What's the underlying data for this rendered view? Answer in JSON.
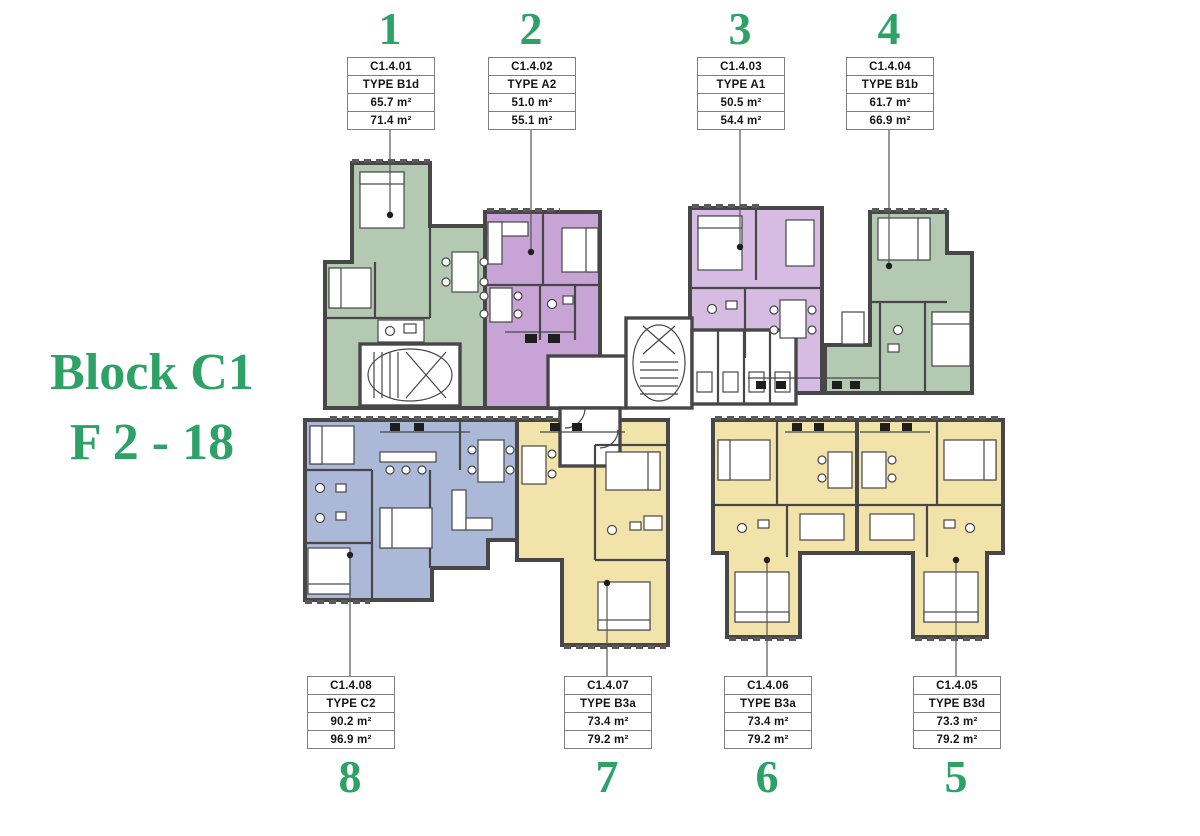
{
  "title": {
    "block": "Block C1",
    "floors": "F 2 - 18"
  },
  "colors": {
    "accent_green": "#2EA166",
    "wall": "#474747",
    "leader": "#555555",
    "box_border": "#7F7F7F",
    "unit_green": "#B3C9B1",
    "unit_purple": "#C7A3D6",
    "unit_lavender": "#D6BCE3",
    "unit_blue": "#ABB8D7",
    "unit_yellow": "#F2E3AA"
  },
  "units": [
    {
      "number": "1",
      "code": "C1.4.01",
      "type": "TYPE B1d",
      "area_net": "65.7 m²",
      "area_gross": "71.4 m²"
    },
    {
      "number": "2",
      "code": "C1.4.02",
      "type": "TYPE A2",
      "area_net": "51.0 m²",
      "area_gross": "55.1 m²"
    },
    {
      "number": "3",
      "code": "C1.4.03",
      "type": "TYPE A1",
      "area_net": "50.5 m²",
      "area_gross": "54.4 m²"
    },
    {
      "number": "4",
      "code": "C1.4.04",
      "type": "TYPE B1b",
      "area_net": "61.7 m²",
      "area_gross": "66.9 m²"
    },
    {
      "number": "5",
      "code": "C1.4.05",
      "type": "TYPE B3d",
      "area_net": "73.3 m²",
      "area_gross": "79.2 m²"
    },
    {
      "number": "6",
      "code": "C1.4.06",
      "type": "TYPE B3a",
      "area_net": "73.4 m²",
      "area_gross": "79.2 m²"
    },
    {
      "number": "7",
      "code": "C1.4.07",
      "type": "TYPE B3a",
      "area_net": "73.4 m²",
      "area_gross": "79.2 m²"
    },
    {
      "number": "8",
      "code": "C1.4.08",
      "type": "TYPE C2",
      "area_net": "90.2 m²",
      "area_gross": "96.9 m²"
    }
  ]
}
